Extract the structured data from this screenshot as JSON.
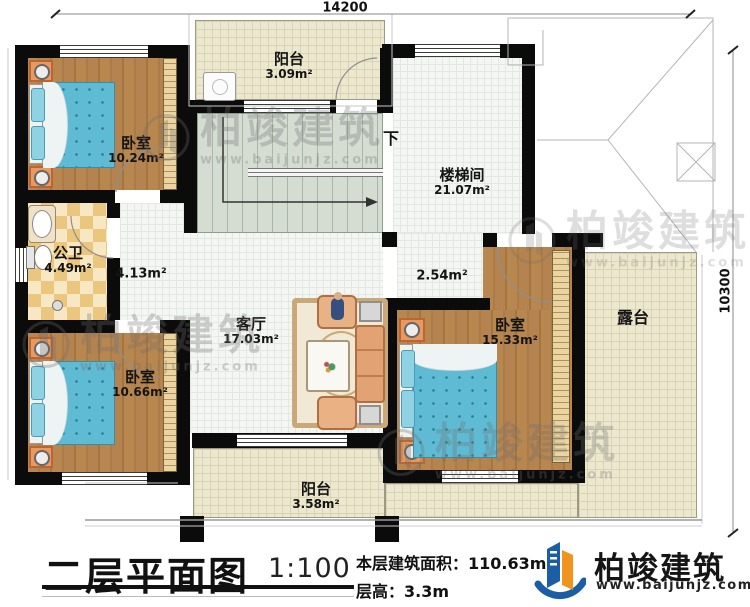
{
  "dimensions": {
    "top": "14200",
    "right": "10300"
  },
  "rooms": {
    "balcony_top": {
      "name": "阳台",
      "area": "3.09m²"
    },
    "bedroom_tl": {
      "name": "卧室",
      "area": "10.24m²"
    },
    "bathroom": {
      "name": "公卫",
      "area": "4.49m²"
    },
    "hallway": {
      "area": "4.13m²"
    },
    "stairwell": {
      "name": "楼梯间",
      "area": "21.07m²",
      "down_label": "下"
    },
    "hall_small": {
      "area": "2.54m²"
    },
    "living": {
      "name": "客厅",
      "area": "17.03m²"
    },
    "bedroom_bl": {
      "name": "卧室",
      "area": "10.66m²"
    },
    "bedroom_r": {
      "name": "卧室",
      "area": "15.33m²"
    },
    "balcony_bottom": {
      "name": "阳台",
      "area": "3.58m²"
    },
    "terrace": {
      "name": "露台"
    }
  },
  "title_block": {
    "title": "二层平面图",
    "scale": "1:100",
    "floor_area": "本层建筑面积：110.63m²",
    "floor_height": "层高：3.3m"
  },
  "brand": {
    "name": "柏竣建筑",
    "website": "www.baijunjz.com"
  },
  "watermark": {
    "name": "柏竣建筑",
    "website": "www.baijunjz.com"
  },
  "colors": {
    "wall": "#0b0b0b",
    "wood_floor": "#b5854f",
    "bed_blue": "#5fbad3",
    "balcony_cream": "#ece8cf",
    "bath_tile": "#eac67e",
    "stair_green": "#d5ddd3",
    "logo_blue": "#1b5ea6",
    "logo_orange": "#f0941f",
    "watermark_gray": "#6f6f6f"
  }
}
